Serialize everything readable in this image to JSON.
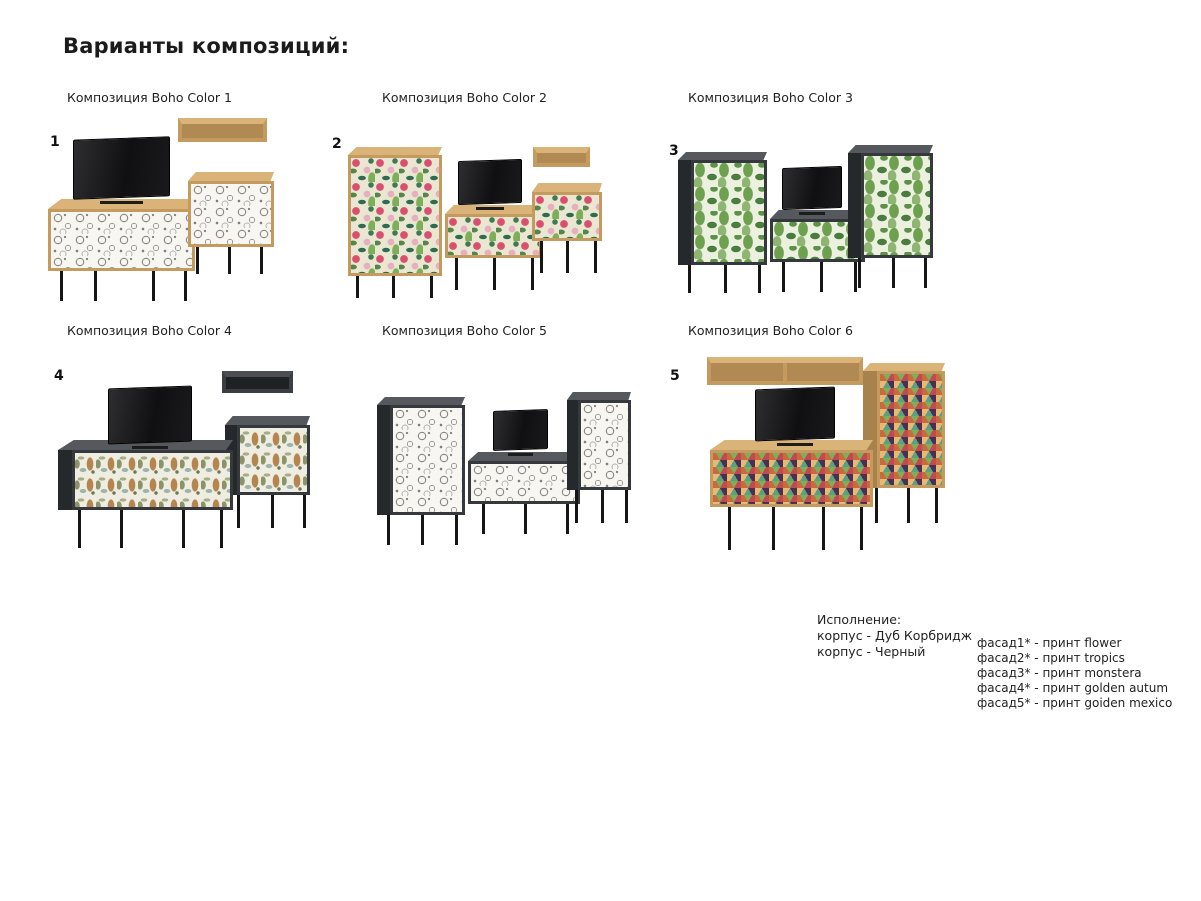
{
  "page": {
    "title": "Варианты композиций:"
  },
  "compositions": [
    {
      "number": "1",
      "label": "Композиция Boho Color 1",
      "print": "flower",
      "body": "oak"
    },
    {
      "number": "2",
      "label": "Композиция Boho Color 2",
      "print": "tropics",
      "body": "oak"
    },
    {
      "number": "3",
      "label": "Композиция Boho Color 3",
      "print": "monstera",
      "body": "black"
    },
    {
      "number": "4",
      "label": "Композиция Boho Color 4",
      "print": "golden autum",
      "body": "black"
    },
    {
      "number": "",
      "label": "Композиция Boho Color 5",
      "print": "flower",
      "body": "black"
    },
    {
      "number": "5",
      "label": "Композиция Boho Color 6",
      "print": "goiden mexico",
      "body": "oak"
    }
  ],
  "legend": {
    "title": "Исполнение:",
    "body_lines": [
      "корпус - Дуб Корбридж",
      "корпус - Черный"
    ],
    "facade_lines": [
      "фасад1* - принт flower",
      "фасад2* - принт tropics",
      "фасад3* - принт monstera",
      "фасад4* - принт golden autum",
      "фасад5* - принт goiden mexico"
    ]
  },
  "colors": {
    "background": "#ffffff",
    "oak_body": "#c49a5e",
    "oak_top": "#d9b377",
    "dark_body": "#3a3e42",
    "legs": "#161616",
    "flower_bg": "#f7f6f1",
    "tropics_pink": "#d94f6e",
    "tropics_green": "#55854a",
    "monstera_green": "#5c9147",
    "autumn_bg": "#efece1",
    "mexico_red": "#c14a52",
    "mexico_teal": "#5ba083"
  }
}
